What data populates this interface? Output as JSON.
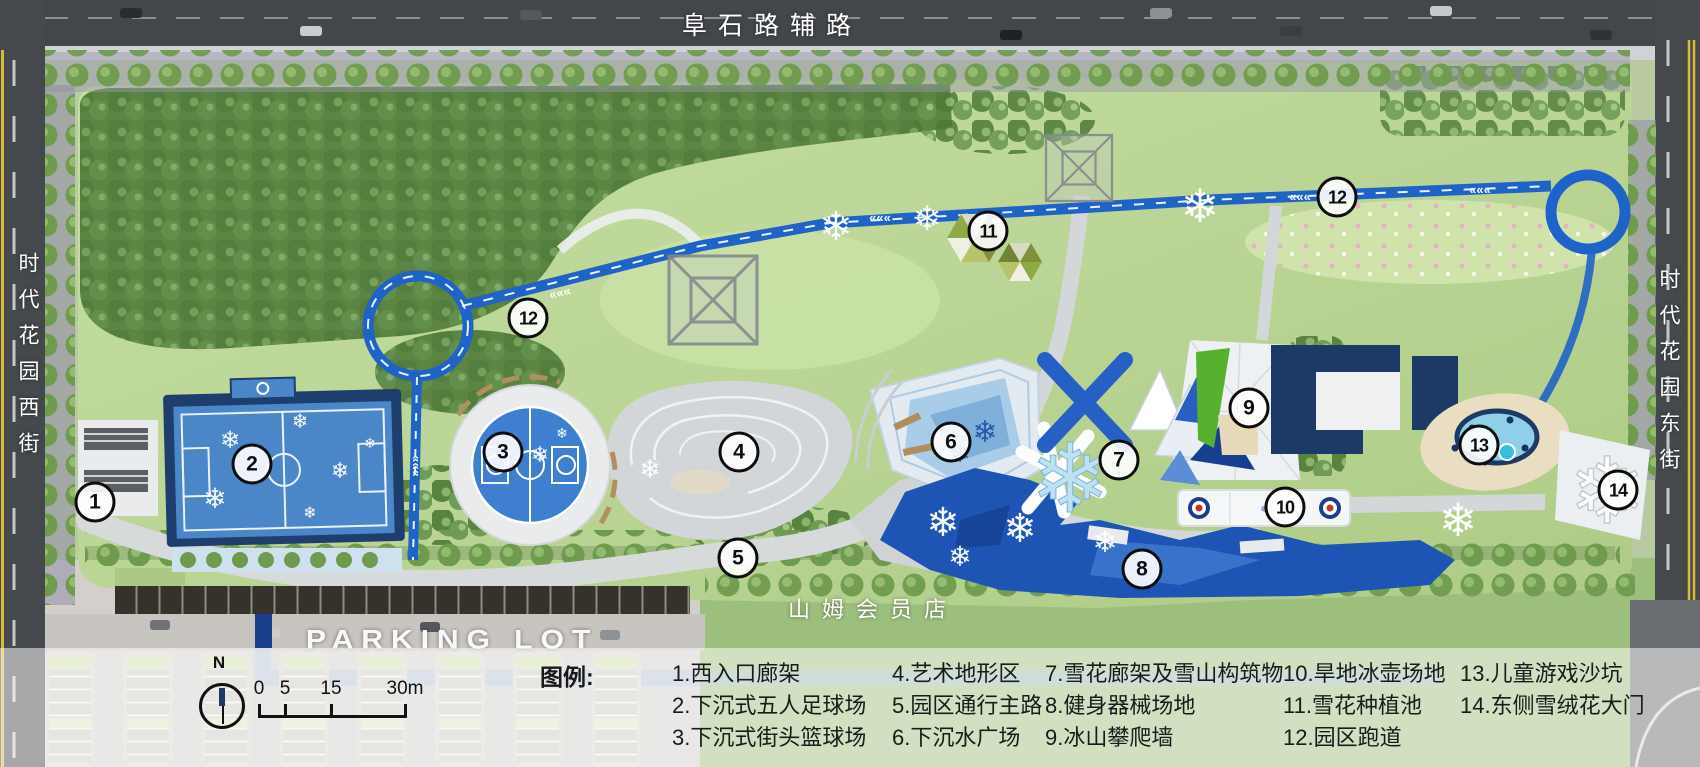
{
  "streets": {
    "north_road": "阜石路辅路",
    "west_street": "时代花园西街",
    "east_street": "时代花园东街",
    "south_store": "山姆会员店",
    "parking": "PARKING LOT"
  },
  "legend": {
    "title": "图例:",
    "items": [
      {
        "num": "1",
        "label": "西入口廊架",
        "text": "1.西入口廊架"
      },
      {
        "num": "2",
        "label": "下沉式五人足球场",
        "text": "2.下沉式五人足球场"
      },
      {
        "num": "3",
        "label": "下沉式街头篮球场",
        "text": "3.下沉式街头篮球场"
      },
      {
        "num": "4",
        "label": "艺术地形区",
        "text": "4.艺术地形区"
      },
      {
        "num": "5",
        "label": "园区通行主路",
        "text": "5.园区通行主路"
      },
      {
        "num": "6",
        "label": "下沉水广场",
        "text": "6.下沉水广场"
      },
      {
        "num": "7",
        "label": "雪花廊架及雪山构筑物",
        "text": "7.雪花廊架及雪山构筑物"
      },
      {
        "num": "8",
        "label": "健身器械场地",
        "text": "8.健身器械场地"
      },
      {
        "num": "9",
        "label": "冰山攀爬墙",
        "text": "9.冰山攀爬墙"
      },
      {
        "num": "10",
        "label": "旱地冰壶场地",
        "text": "10.旱地冰壶场地"
      },
      {
        "num": "11",
        "label": "雪花种植池",
        "text": "11.雪花种植池"
      },
      {
        "num": "12",
        "label": "园区跑道",
        "text": "12.园区跑道"
      },
      {
        "num": "13",
        "label": "儿童游戏沙坑",
        "text": "13.儿童游戏沙坑"
      },
      {
        "num": "14",
        "label": "东侧雪绒花大门",
        "text": "14.东侧雪绒花大门"
      }
    ],
    "columns": [
      [
        0,
        1,
        2
      ],
      [
        3,
        4,
        5
      ],
      [
        6,
        7,
        8
      ],
      [
        9,
        10,
        11
      ],
      [
        12,
        13
      ]
    ]
  },
  "scale": {
    "north_label": "N",
    "ticks": [
      "0",
      "5",
      "15",
      "30m"
    ]
  },
  "markers": [
    {
      "num": "1",
      "x": 95,
      "y": 502
    },
    {
      "num": "2",
      "x": 252,
      "y": 464
    },
    {
      "num": "3",
      "x": 503,
      "y": 452
    },
    {
      "num": "4",
      "x": 739,
      "y": 452
    },
    {
      "num": "5",
      "x": 738,
      "y": 558
    },
    {
      "num": "6",
      "x": 951,
      "y": 442
    },
    {
      "num": "7",
      "x": 1119,
      "y": 460
    },
    {
      "num": "8",
      "x": 1142,
      "y": 569
    },
    {
      "num": "9",
      "x": 1249,
      "y": 408
    },
    {
      "num": "10",
      "x": 1285,
      "y": 507
    },
    {
      "num": "11",
      "x": 988,
      "y": 231
    },
    {
      "num": "12",
      "x": 528,
      "y": 318
    },
    {
      "num": "12",
      "x": 1337,
      "y": 197
    },
    {
      "num": "13",
      "x": 1479,
      "y": 445
    },
    {
      "num": "14",
      "x": 1618,
      "y": 490
    }
  ],
  "colors": {
    "track_blue": "#1f63c8",
    "court_blue": "#4a86c8",
    "deep_water": "#1e55b4",
    "building_navy": "#1d3a66",
    "lawn_green": "#bcd79a",
    "forest_green": "#5c8544",
    "climb_green": "#57b02e",
    "road_gray": "#43474b",
    "overlay_white": "rgba(255,255,255,0.52)"
  }
}
